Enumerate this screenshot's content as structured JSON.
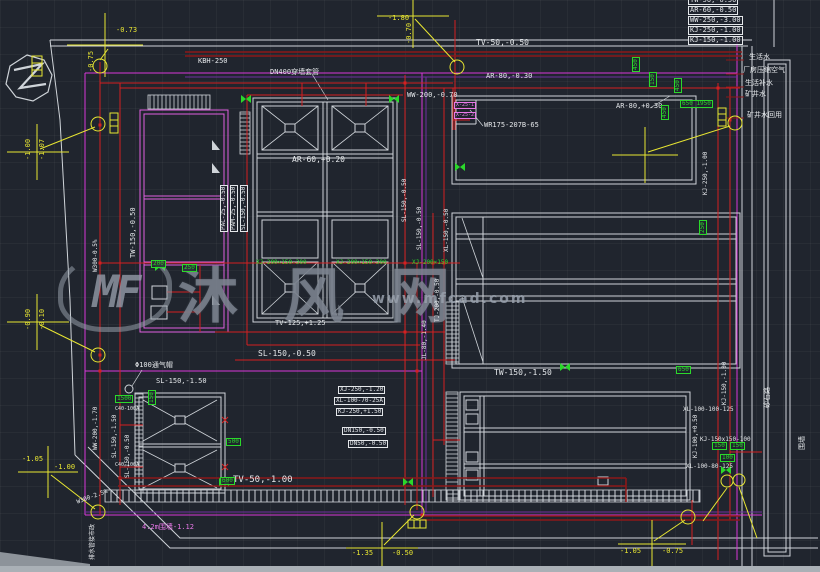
{
  "watermark": {
    "logo_text": "MF",
    "brand": "沐风网",
    "url": "www.mfcad.com"
  },
  "legend": {
    "rows": [
      "TW-50,-0.50",
      "AR-60,-0.50",
      "WW-250,-3.00",
      "KJ-250,-1.00",
      "KJ-150,-1.00"
    ]
  },
  "colors": {
    "background": "#20252e",
    "white_line": "#cfd4d9",
    "red_pipe": "#d42020",
    "dark_red_pipe": "#8c1818",
    "magenta_line": "#d838d8",
    "purple_line": "#7030a0",
    "yellow_annotation": "#e8e632",
    "green_marker": "#2bd82b",
    "watermark_gray": "#98a0ac"
  },
  "drawing": {
    "labels": [
      {
        "t": "TV-50,-0.50",
        "x": 476,
        "y": 39,
        "s": 8,
        "n": "pipe-label-tv50"
      },
      {
        "t": "AR-80,-0.30",
        "x": 486,
        "y": 73,
        "s": 7,
        "n": "pipe-label-ar80"
      },
      {
        "t": "WW-200,-0.70",
        "x": 407,
        "y": 92,
        "s": 7,
        "n": "pipe-label-ww200"
      },
      {
        "t": "AR-80,+0.30",
        "x": 616,
        "y": 103,
        "s": 7,
        "n": "pipe-label-ar80-plus"
      },
      {
        "t": "WR175-207B-65",
        "x": 484,
        "y": 122,
        "s": 7,
        "n": "equipment-label-wr175"
      },
      {
        "t": "AR-60,+0.20",
        "x": 292,
        "y": 156,
        "s": 8,
        "n": "pipe-label-ar60"
      },
      {
        "t": "KBH-250",
        "x": 198,
        "y": 58,
        "s": 7,
        "n": "pipe-label-kbh250"
      },
      {
        "t": "DN400穿墙套管",
        "x": 270,
        "y": 69,
        "s": 7,
        "n": "sleeve-label-dn400"
      },
      {
        "t": "TV-125,+1.25",
        "x": 275,
        "y": 320,
        "s": 7,
        "n": "pipe-label-tv125"
      },
      {
        "t": "SL-150,-0.50",
        "x": 258,
        "y": 350,
        "s": 8,
        "n": "pipe-label-sl150"
      },
      {
        "t": "TW-150,-1.50",
        "x": 494,
        "y": 369,
        "s": 8,
        "n": "pipe-label-tw150"
      },
      {
        "t": "TV-50,-1.00",
        "x": 233,
        "y": 476,
        "s": 9,
        "n": "pipe-label-tv50-bottom"
      },
      {
        "t": "Φ100通气帽",
        "x": 135,
        "y": 362,
        "s": 7,
        "n": "vent-cap-label"
      },
      {
        "t": "SL-150,-1.50",
        "x": 156,
        "y": 378,
        "s": 7,
        "n": "pipe-label-sl150-b"
      },
      {
        "t": "TW-150,-0.50",
        "x": 130,
        "y": 258,
        "r": -90,
        "s": 7,
        "n": "pipe-label-tw150-vert"
      },
      {
        "t": "PAC-25,-0.50",
        "x": 220,
        "y": 232,
        "r": -90,
        "s": 6,
        "b": 1,
        "n": "dosing-label-pac"
      },
      {
        "t": "PAM-25,-0.50",
        "x": 230,
        "y": 232,
        "r": -90,
        "s": 6,
        "b": 1,
        "n": "dosing-label-pam"
      },
      {
        "t": "SL-150,-0.50",
        "x": 240,
        "y": 232,
        "r": -90,
        "s": 6,
        "b": 1,
        "n": "dosing-label-sl"
      },
      {
        "t": "WW-200,-1.70",
        "x": 93,
        "y": 450,
        "r": -90,
        "s": 6,
        "n": "pipe-label-ww200-vert"
      },
      {
        "t": "SL-150,-1.50",
        "x": 112,
        "y": 458,
        "r": -90,
        "s": 6,
        "n": "pipe-label-sl150-vert"
      },
      {
        "t": "SL-150,-0.50",
        "x": 125,
        "y": 478,
        "r": -90,
        "s": 6,
        "n": "pipe-label-sl150-vert2"
      },
      {
        "t": "W300-0.5%",
        "x": 93,
        "y": 272,
        "r": -90,
        "s": 6,
        "n": "sewer-slope-label"
      },
      {
        "t": "W300-2.5%",
        "x": 76,
        "y": 500,
        "r": -20,
        "s": 6,
        "n": "sewer-slope-label2"
      },
      {
        "t": "排水管接市政",
        "x": 90,
        "y": 560,
        "r": -90,
        "s": 6,
        "n": "drain-to-municipal-note"
      },
      {
        "t": "4.2m围墙-1.12",
        "x": 142,
        "y": 524,
        "s": 7,
        "c": "m",
        "n": "fence-label"
      },
      {
        "t": "SL-150,-0.50",
        "x": 402,
        "y": 222,
        "r": -90,
        "s": 6,
        "n": "pipe-label-mid1"
      },
      {
        "t": "SL-150,-0.50",
        "x": 417,
        "y": 250,
        "r": -90,
        "s": 6,
        "n": "pipe-label-mid2"
      },
      {
        "t": "XL-150,-0.50",
        "x": 444,
        "y": 252,
        "r": -90,
        "s": 6,
        "n": "pipe-label-mid3"
      },
      {
        "t": "TJ-200,-0.50",
        "x": 435,
        "y": 322,
        "r": -90,
        "s": 6,
        "n": "pipe-label-mid4"
      },
      {
        "t": "JL-80,-1.40",
        "x": 422,
        "y": 360,
        "r": -90,
        "s": 6,
        "n": "pipe-label-mid5"
      },
      {
        "t": "KJ-250,-1.00",
        "x": 703,
        "y": 195,
        "r": -90,
        "s": 6,
        "n": "pipe-label-kj250-vert"
      },
      {
        "t": "KJ-150,-1.00",
        "x": 722,
        "y": 405,
        "r": -90,
        "s": 6,
        "n": "pipe-label-kj150-vert"
      },
      {
        "t": "KJ-150x150-100",
        "x": 700,
        "y": 437,
        "s": 6,
        "n": "fitting-label-kj"
      },
      {
        "t": "XL-100-100-125",
        "x": 683,
        "y": 407,
        "s": 6,
        "n": "fitting-label-xl1"
      },
      {
        "t": "XL-100-80-125",
        "x": 686,
        "y": 464,
        "s": 6,
        "n": "fitting-label-xl2"
      },
      {
        "t": "KJ-100,+0.50",
        "x": 693,
        "y": 458,
        "r": -90,
        "s": 6,
        "n": "pipe-label-kj100"
      },
      {
        "t": "砂石路",
        "x": 764,
        "y": 408,
        "r": -90,
        "s": 7,
        "n": "road-label"
      },
      {
        "t": "围墙",
        "x": 799,
        "y": 450,
        "r": -90,
        "s": 7,
        "n": "wall-label"
      },
      {
        "t": "生活水",
        "x": 749,
        "y": 54,
        "s": 7,
        "n": "note-domestic-water"
      },
      {
        "t": "厂房压缩空气",
        "x": 743,
        "y": 67,
        "s": 7,
        "n": "note-compressed-air"
      },
      {
        "t": "生活补水",
        "x": 745,
        "y": 80,
        "s": 7,
        "n": "note-makeup-water"
      },
      {
        "t": "矿井水",
        "x": 745,
        "y": 91,
        "s": 7,
        "n": "note-mine-water"
      },
      {
        "t": "矿井水回用",
        "x": 747,
        "y": 112,
        "s": 7,
        "n": "note-mine-water-reuse"
      },
      {
        "t": "-0.73",
        "x": 116,
        "y": 27,
        "s": 7,
        "c": "y",
        "n": "elevation-label"
      },
      {
        "t": "-0.75",
        "x": 88,
        "y": 72,
        "r": -90,
        "s": 7,
        "c": "y",
        "n": "elevation-label"
      },
      {
        "t": "-1.80",
        "x": 388,
        "y": 15,
        "s": 7,
        "c": "y",
        "n": "elevation-label"
      },
      {
        "t": "-0.70",
        "x": 406,
        "y": 44,
        "r": -90,
        "s": 7,
        "c": "y",
        "n": "elevation-label"
      },
      {
        "t": "-1.00",
        "x": 25,
        "y": 160,
        "r": -90,
        "s": 7,
        "c": "y",
        "n": "elevation-label"
      },
      {
        "t": "-1.07",
        "x": 39,
        "y": 160,
        "r": -90,
        "s": 7,
        "c": "y",
        "n": "elevation-label"
      },
      {
        "t": "-0.90",
        "x": 25,
        "y": 330,
        "r": -90,
        "s": 7,
        "c": "y",
        "n": "elevation-label"
      },
      {
        "t": "-0.10",
        "x": 39,
        "y": 330,
        "r": -90,
        "s": 7,
        "c": "y",
        "n": "elevation-label"
      },
      {
        "t": "-1.05",
        "x": 22,
        "y": 456,
        "s": 7,
        "c": "y",
        "n": "elevation-label"
      },
      {
        "t": "-1.00",
        "x": 54,
        "y": 464,
        "s": 7,
        "c": "y",
        "n": "elevation-label"
      },
      {
        "t": "-1.35",
        "x": 352,
        "y": 550,
        "s": 7,
        "c": "y",
        "n": "elevation-label"
      },
      {
        "t": "-0.50",
        "x": 392,
        "y": 550,
        "s": 7,
        "c": "y",
        "n": "elevation-label"
      },
      {
        "t": "-1.05",
        "x": 620,
        "y": 548,
        "s": 7,
        "c": "y",
        "n": "elevation-label"
      },
      {
        "t": "-0.75",
        "x": 662,
        "y": 548,
        "s": 7,
        "c": "y",
        "n": "elevation-label"
      },
      {
        "t": "450",
        "x": 632,
        "y": 72,
        "r": -90,
        "s": 6,
        "c": "g",
        "b": 1,
        "n": "dim-green"
      },
      {
        "t": "150",
        "x": 649,
        "y": 87,
        "r": -90,
        "s": 6,
        "c": "g",
        "b": 1,
        "n": "dim-green"
      },
      {
        "t": "450",
        "x": 674,
        "y": 93,
        "r": -90,
        "s": 6,
        "c": "g",
        "b": 1,
        "n": "dim-green"
      },
      {
        "t": "650 1950",
        "x": 680,
        "y": 100,
        "s": 6,
        "c": "g",
        "b": 1,
        "n": "dim-green"
      },
      {
        "t": "450",
        "x": 661,
        "y": 120,
        "r": -90,
        "s": 6,
        "c": "g",
        "b": 1,
        "n": "dim-green"
      },
      {
        "t": "250",
        "x": 699,
        "y": 235,
        "r": -90,
        "s": 6,
        "c": "g",
        "b": 1,
        "n": "dim-green"
      },
      {
        "t": "200",
        "x": 151,
        "y": 260,
        "s": 6,
        "c": "g",
        "b": 1,
        "n": "dim-green"
      },
      {
        "t": "250",
        "x": 182,
        "y": 264,
        "s": 6,
        "c": "g",
        "b": 1,
        "n": "dim-green"
      },
      {
        "t": "1500",
        "x": 115,
        "y": 395,
        "s": 6,
        "c": "g",
        "b": 1,
        "n": "dim-green"
      },
      {
        "t": "150",
        "x": 148,
        "y": 405,
        "r": -90,
        "s": 6,
        "c": "g",
        "b": 1,
        "n": "dim-green"
      },
      {
        "t": "500",
        "x": 226,
        "y": 438,
        "s": 6,
        "c": "g",
        "b": 1,
        "n": "dim-green"
      },
      {
        "t": "600",
        "x": 220,
        "y": 477,
        "s": 6,
        "c": "g",
        "b": 1,
        "n": "dim-green"
      },
      {
        "t": "650",
        "x": 676,
        "y": 366,
        "s": 6,
        "c": "g",
        "b": 1,
        "n": "dim-green"
      },
      {
        "t": "150",
        "x": 712,
        "y": 442,
        "s": 6,
        "c": "g",
        "b": 1,
        "n": "dim-green"
      },
      {
        "t": "150",
        "x": 730,
        "y": 442,
        "s": 6,
        "c": "g",
        "b": 1,
        "n": "dim-green"
      },
      {
        "t": "100",
        "x": 720,
        "y": 454,
        "s": 6,
        "c": "g",
        "b": 1,
        "n": "dim-green"
      },
      {
        "t": "XJ-200×150-300",
        "x": 256,
        "y": 260,
        "s": 6,
        "c": "g",
        "n": "channel-label"
      },
      {
        "t": "XJ-200×150-300",
        "x": 336,
        "y": 260,
        "s": 6,
        "c": "g",
        "n": "channel-label"
      },
      {
        "t": "XJ-200×150",
        "x": 412,
        "y": 260,
        "s": 6,
        "c": "g",
        "n": "channel-label"
      },
      {
        "t": "XJ-250,-1.20",
        "x": 338,
        "y": 386,
        "s": 6,
        "b": 1,
        "n": "fitting-stack-label"
      },
      {
        "t": "XL-100-70-25A",
        "x": 334,
        "y": 397,
        "s": 6,
        "b": 1,
        "n": "fitting-stack-label"
      },
      {
        "t": "KJ-250,+1.50",
        "x": 336,
        "y": 408,
        "s": 6,
        "b": 1,
        "n": "fitting-stack-label"
      },
      {
        "t": "DN150,-0.50",
        "x": 342,
        "y": 427,
        "s": 6,
        "b": 1,
        "n": "fitting-stack-label"
      },
      {
        "t": "DN50,-0.50",
        "x": 348,
        "y": 440,
        "s": 6,
        "b": 1,
        "n": "fitting-stack-label"
      },
      {
        "t": "X-25-1",
        "x": 454,
        "y": 102,
        "s": 5,
        "c": "m",
        "b": 1,
        "n": "small-magenta-label"
      },
      {
        "t": "X-25-2",
        "x": 454,
        "y": 112,
        "s": 5,
        "c": "m",
        "b": 1,
        "n": "small-magenta-label"
      },
      {
        "t": "C40-100A",
        "x": 115,
        "y": 407,
        "s": 5,
        "n": "equipment-tag"
      },
      {
        "t": "C40-100A",
        "x": 115,
        "y": 463,
        "s": 5,
        "n": "equipment-tag"
      }
    ]
  }
}
